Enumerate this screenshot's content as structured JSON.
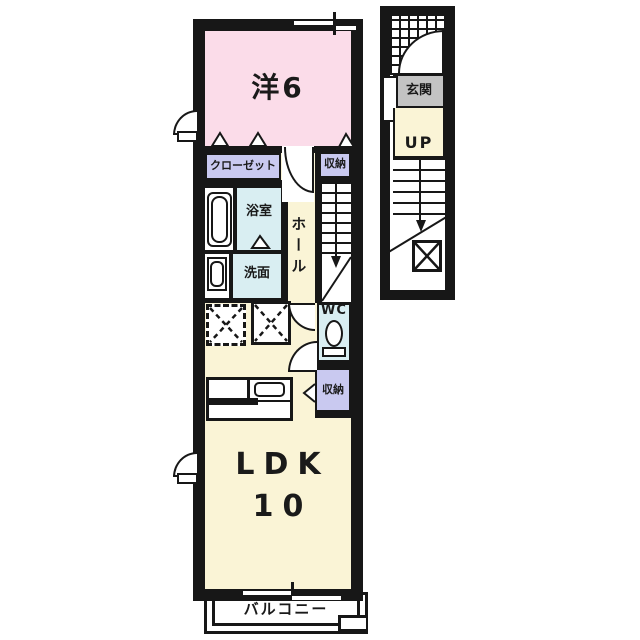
{
  "unit": {
    "western_room": {
      "label": "洋6"
    },
    "closet": {
      "label": "クローゼット"
    },
    "storage_upper": {
      "label": "収納"
    },
    "bathroom": {
      "label": "浴室"
    },
    "washroom": {
      "label": "洗面"
    },
    "hall": {
      "label": "ホール"
    },
    "wc": {
      "label": "WC"
    },
    "storage_lower": {
      "label": "収納"
    },
    "ldk": {
      "label": "LDK",
      "size": "10"
    },
    "balcony": {
      "label": "バルコニー"
    }
  },
  "stairwell": {
    "entrance": {
      "label": "玄関"
    },
    "up": {
      "label": "UP"
    }
  },
  "icons": {
    "bathtub": "rounded-rect",
    "washbasin": "rounded-rect",
    "toilet": "ellipse-with-base",
    "kitchen_counter": "divided-rect-with-sink",
    "appliance_space": "dashed-x-box",
    "pipe_space": "solid-x-box",
    "stairs": "tread-lines-with-arrow",
    "door": "quarter-arc",
    "window": "swing-arc",
    "folding_door": "triangle",
    "porch": "grid-hatch"
  },
  "colors": {
    "wall": "#171717",
    "western": "#fbdce9",
    "ldk": "#faf4d6",
    "storage": "#c9c9f0",
    "wet": "#d9eef2",
    "entrance": "#c3c3c3"
  }
}
